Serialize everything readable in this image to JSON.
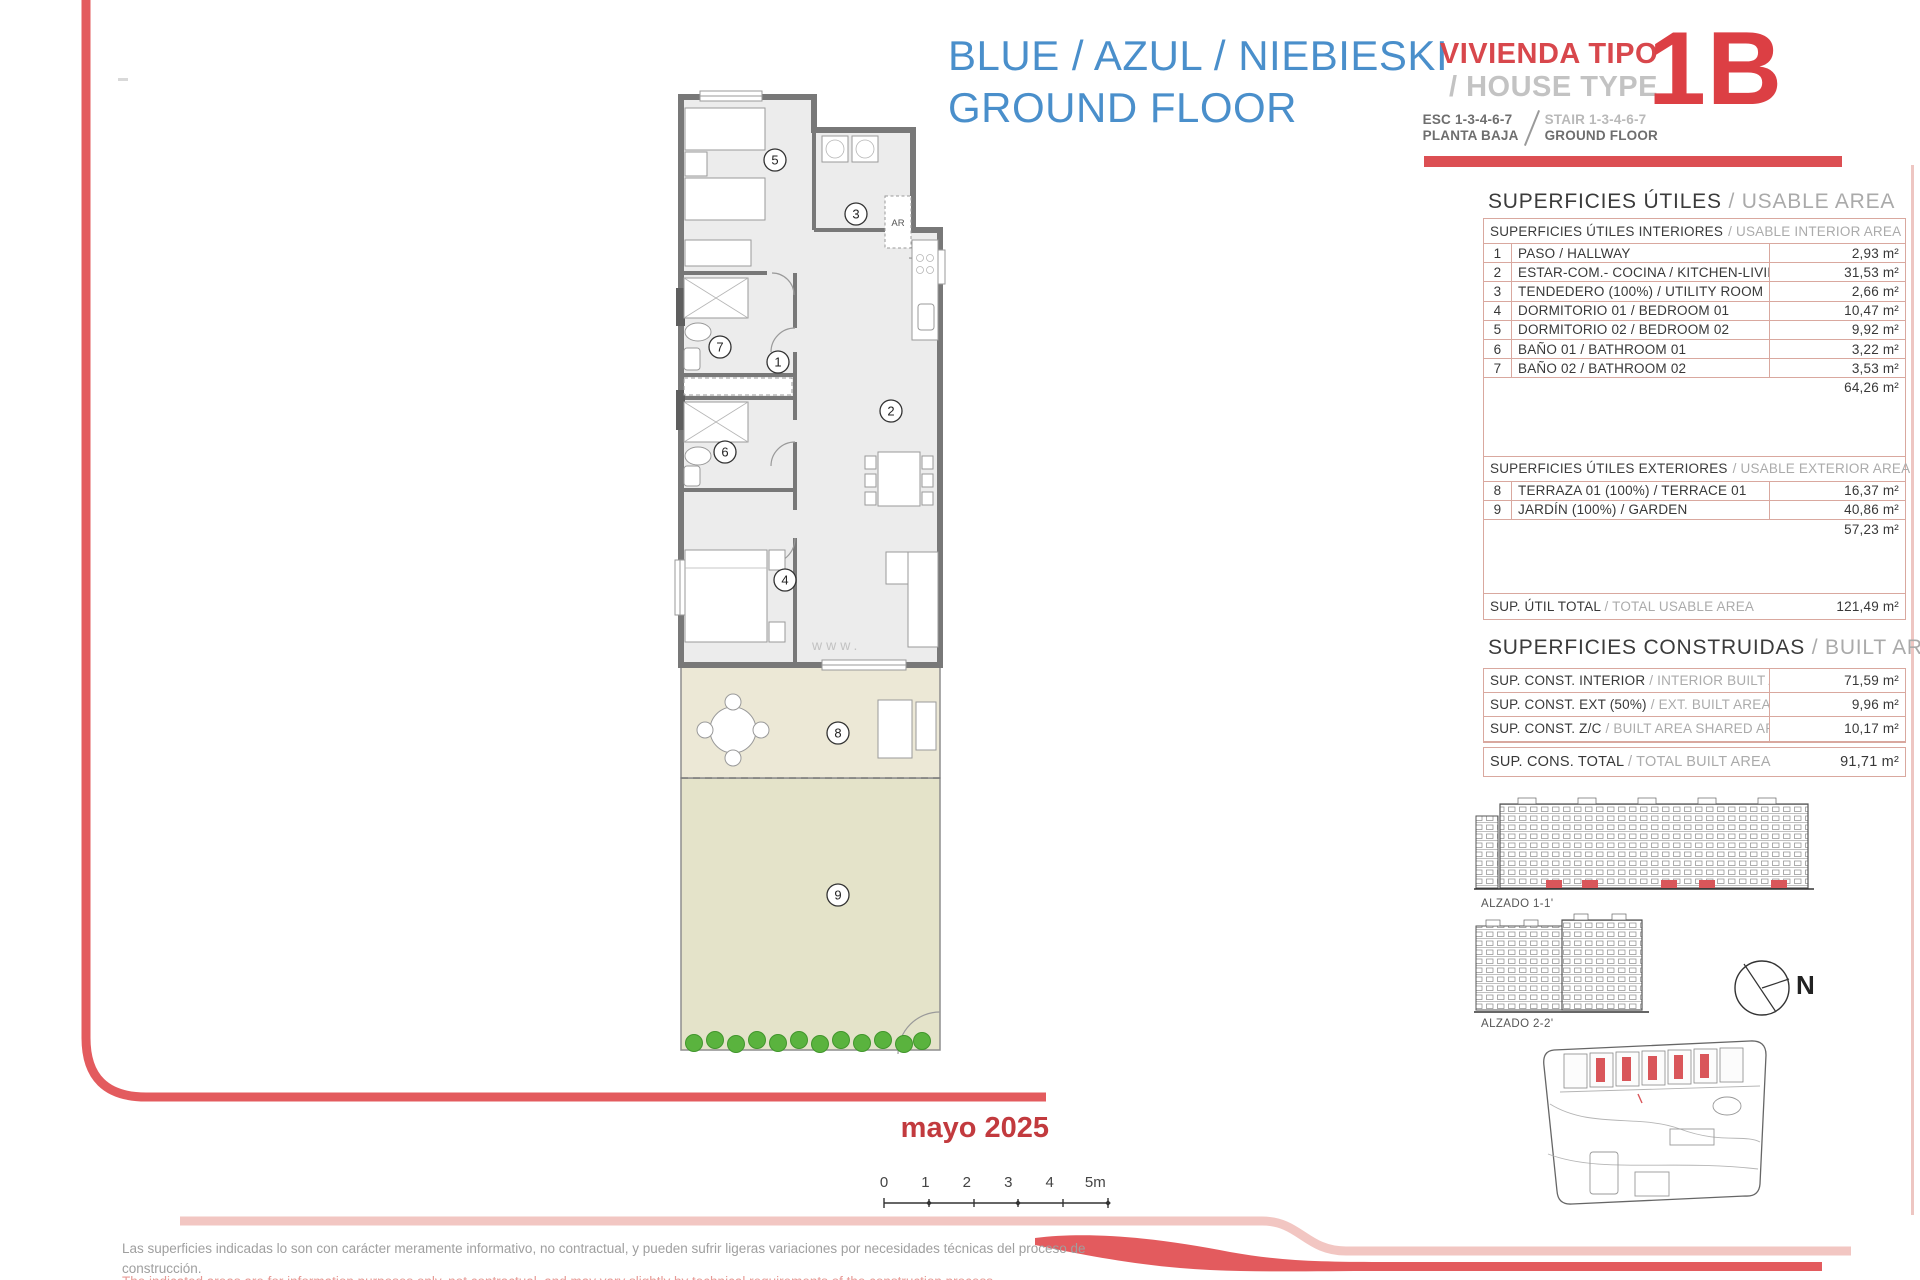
{
  "header": {
    "title_line1": "BLUE / AZUL / NIEBIESKI",
    "title_line2": "GROUND FLOOR",
    "vivienda_tipo": "VIVIENDA TIPO",
    "house_type": "/ HOUSE TYPE",
    "esc": "ESC 1-3-4-6-7",
    "planta_baja": "PLANTA BAJA",
    "stair": "STAIR 1-3-4-6-7",
    "ground_floor": "GROUND FLOOR",
    "unit_code": "1B"
  },
  "usable_area": {
    "title_es": "SUPERFICIES ÚTILES",
    "title_en": "/ USABLE AREA",
    "interior_header_es": "SUPERFICIES ÚTILES INTERIORES",
    "interior_header_en": "/ USABLE INTERIOR AREA",
    "interior_rows": [
      {
        "num": "1",
        "desc": "PASO / HALLWAY",
        "value": "2,93 m²"
      },
      {
        "num": "2",
        "desc": "ESTAR-COM.- COCINA / KITCHEN-LIVING",
        "value": "31,53 m²"
      },
      {
        "num": "3",
        "desc": "TENDEDERO (100%) / UTILITY ROOM",
        "value": "2,66 m²"
      },
      {
        "num": "4",
        "desc": "DORMITORIO 01 / BEDROOM 01",
        "value": "10,47 m²"
      },
      {
        "num": "5",
        "desc": "DORMITORIO 02 / BEDROOM 02",
        "value": "9,92 m²"
      },
      {
        "num": "6",
        "desc": "BAÑO 01 / BATHROOM 01",
        "value": "3,22 m²"
      },
      {
        "num": "7",
        "desc": "BAÑO 02 / BATHROOM 02",
        "value": "3,53 m²"
      }
    ],
    "interior_subtotal": "64,26 m²",
    "exterior_header_es": "SUPERFICIES ÚTILES EXTERIORES",
    "exterior_header_en": "/ USABLE EXTERIOR AREA",
    "exterior_rows": [
      {
        "num": "8",
        "desc": "TERRAZA 01 (100%) / TERRACE 01",
        "value": "16,37 m²"
      },
      {
        "num": "9",
        "desc": "JARDÍN (100%) / GARDEN",
        "value": "40,86 m²"
      }
    ],
    "exterior_subtotal": "57,23 m²",
    "total_label_es": "SUP. ÚTIL TOTAL",
    "total_label_en": "/ TOTAL USABLE AREA",
    "total_value": "121,49 m²"
  },
  "built_area": {
    "title_es": "SUPERFICIES CONSTRUIDAS",
    "title_en": "/ BUILT AREA",
    "rows": [
      {
        "label_es": "SUP. CONST. INTERIOR",
        "label_en": "/ INTERIOR BUILT AREA",
        "value": "71,59 m²"
      },
      {
        "label_es": "SUP. CONST. EXT (50%)",
        "label_en": "/ EXT. BUILT AREA",
        "value": "9,96 m²"
      },
      {
        "label_es": "SUP. CONST. Z/C",
        "label_en": "/ BUILT AREA SHARED AREAS",
        "value": "10,17 m²"
      }
    ],
    "total_label_es": "SUP. CONS. TOTAL",
    "total_label_en": "/ TOTAL BUILT AREA",
    "total_value": "91,71 m²"
  },
  "plan": {
    "labels": {
      "hallway": "1",
      "kitchen_living": "2",
      "utility": "3",
      "bedroom01": "4",
      "bedroom02": "5",
      "bathroom01": "6",
      "bathroom02": "7",
      "terrace": "8",
      "garden": "9",
      "storage": "AR"
    },
    "watermark": "www."
  },
  "elevations": {
    "alzado1": "ALZADO 1-1'",
    "alzado2": "ALZADO 2-2'",
    "north": "N"
  },
  "footer": {
    "date": "mayo 2025",
    "scale_ticks": [
      "0",
      "1",
      "2",
      "3",
      "4",
      "5m"
    ],
    "disclaimer_es_1": "Las superficies indicadas lo son con carácter meramente informativo, no contractual, y pueden sufrir ligeras variaciones por necesidades técnicas del proceso de",
    "disclaimer_es_2": "construcción.",
    "disclaimer_en": "The indicated areas are for information purposes only, not contractual, and may vary slightly by technical requirements of the construction process."
  }
}
